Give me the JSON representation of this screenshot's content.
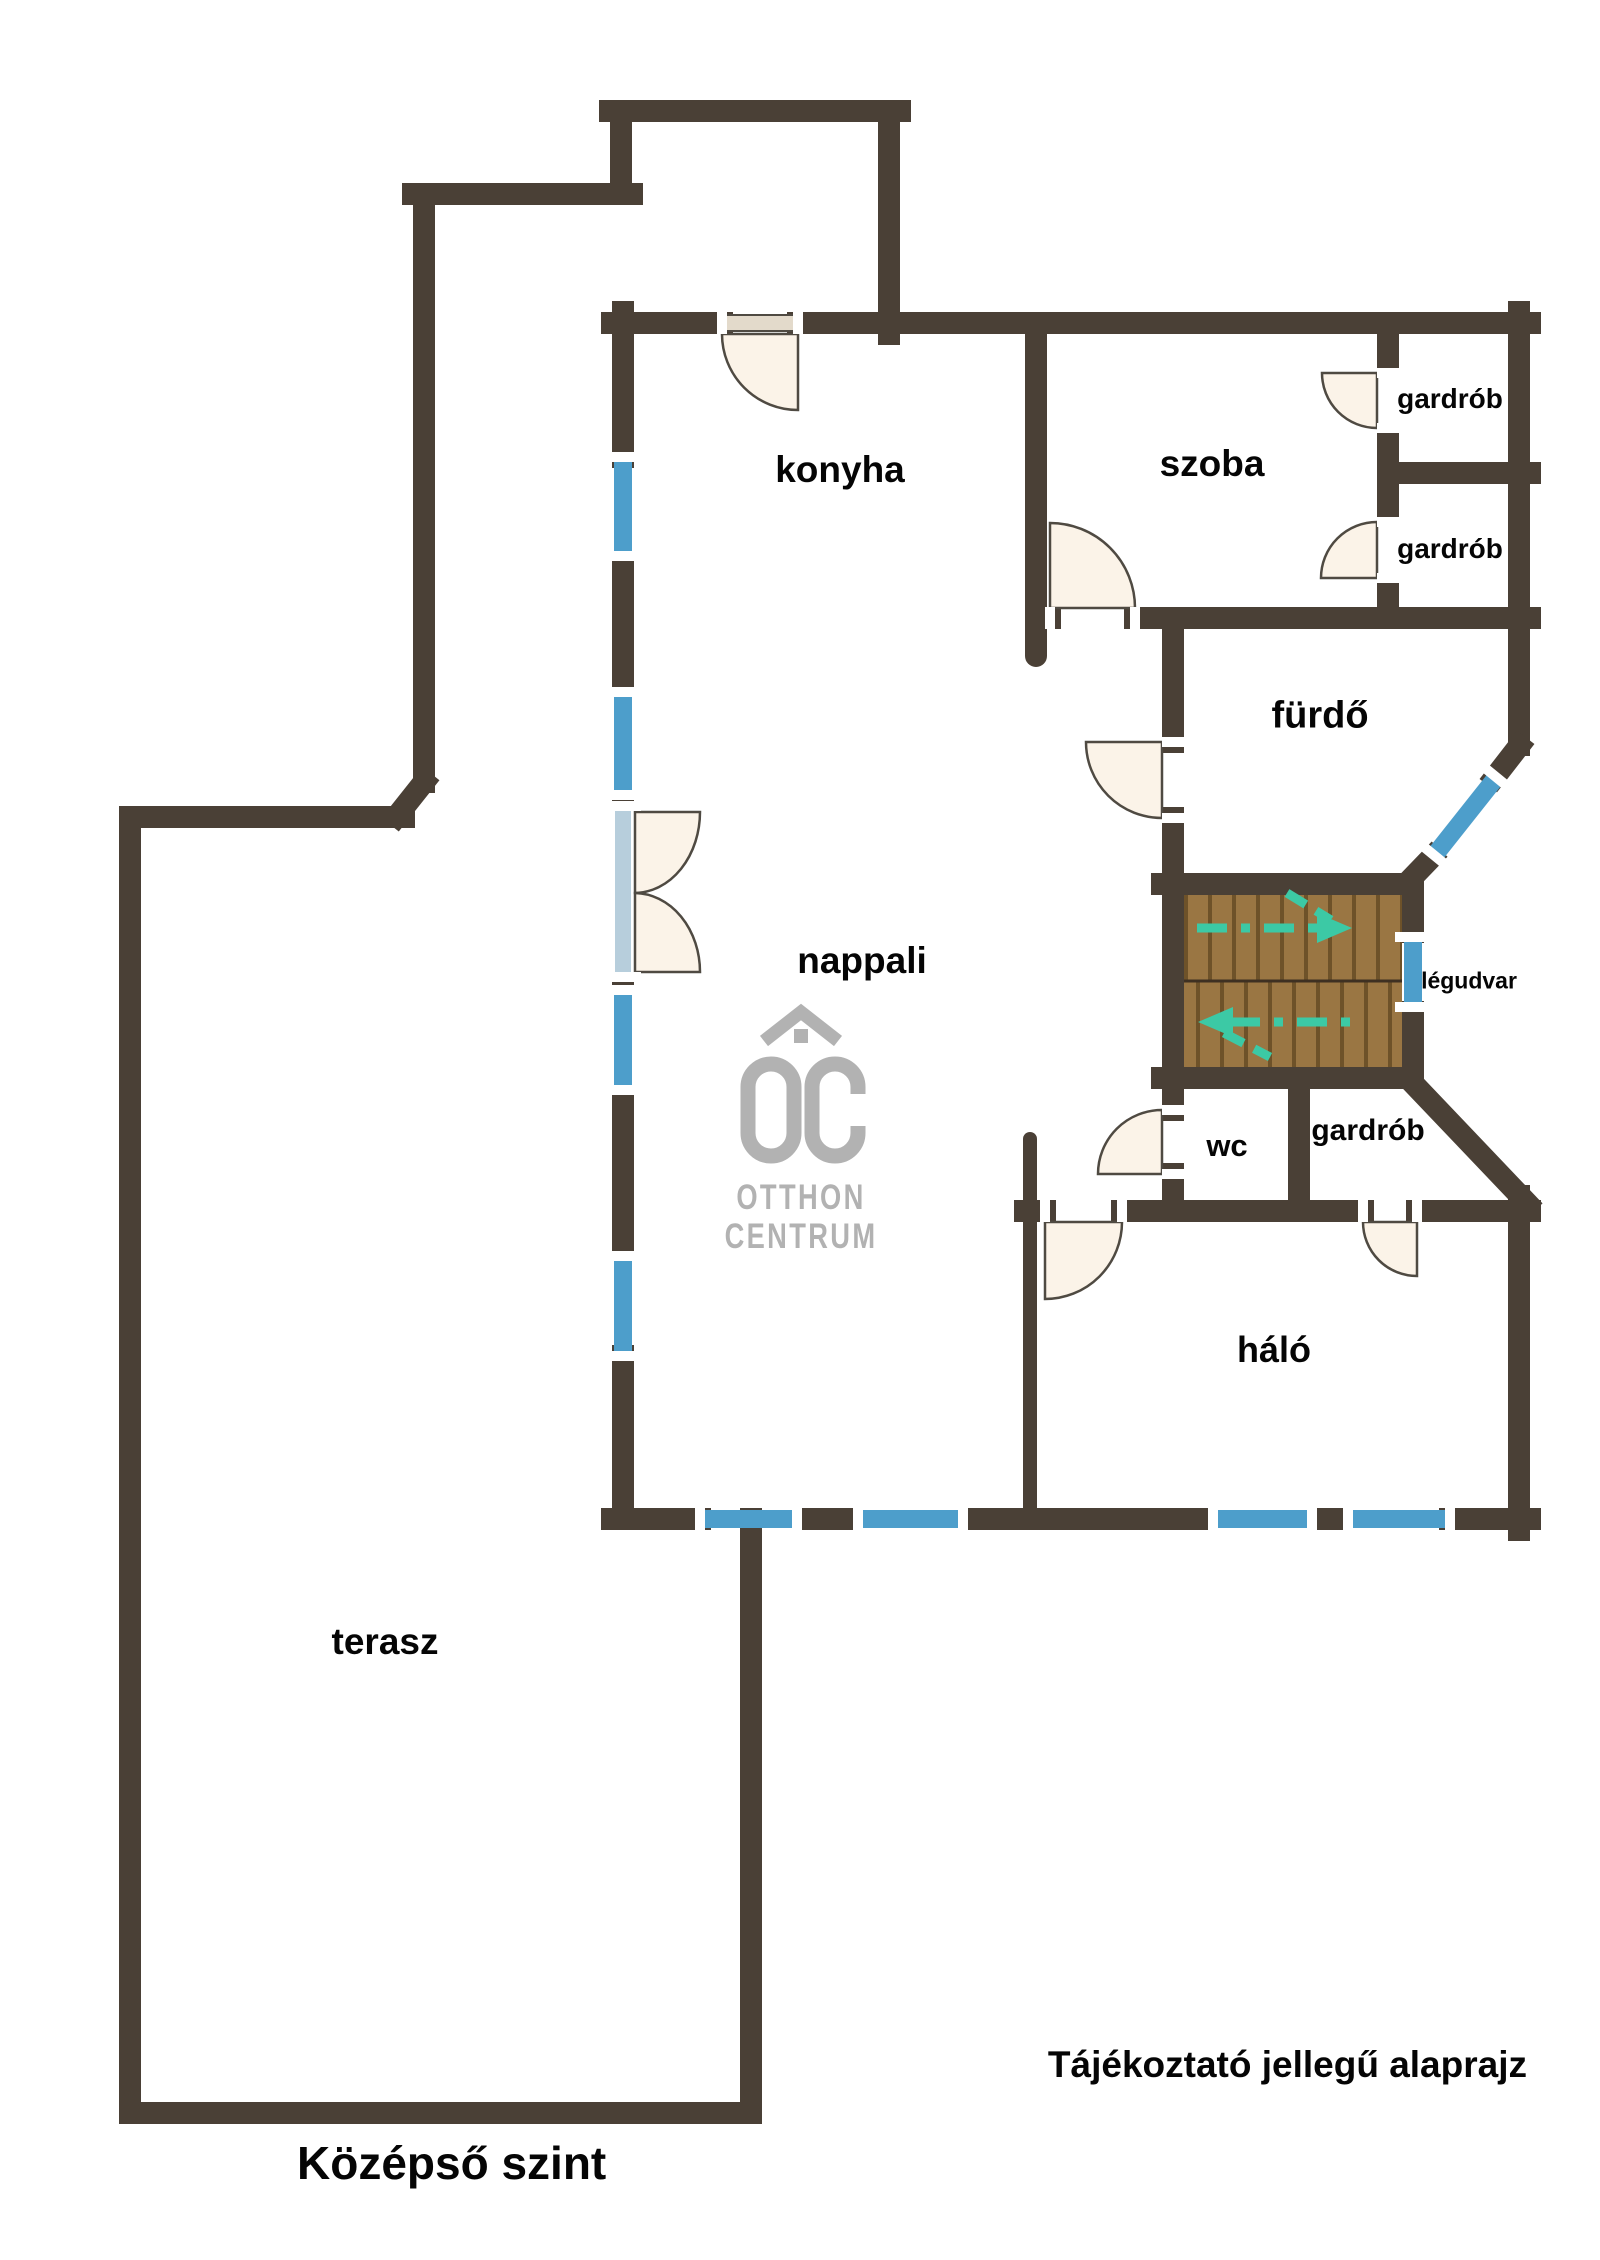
{
  "plan": {
    "level_title": "Középső szint",
    "disclaimer": "Tájékoztató jellegű alaprajz",
    "rooms": [
      {
        "label": "konyha"
      },
      {
        "label": "szoba"
      },
      {
        "label": "gardrób"
      },
      {
        "label": "gardrób"
      },
      {
        "label": "fürdő"
      },
      {
        "label": "nappali"
      },
      {
        "label": "légudvar"
      },
      {
        "label": "wc"
      },
      {
        "label": "gardrób"
      },
      {
        "label": "háló"
      },
      {
        "label": "terasz"
      }
    ]
  },
  "logo": {
    "monogram": "OC",
    "line1": "OTTHON",
    "line2": "CENTRUM"
  },
  "colors": {
    "wall": "#4A4036",
    "window": "#4D9ECB",
    "glazing": "#B7CEDC",
    "door": "#FBF3E8",
    "doortan": "#E3DACB",
    "doorline": "#4F4A42",
    "wood1": "#9A7643",
    "woodline": "#6E5229",
    "stairdiv": "#3E3022",
    "teal": "#3CC9A5",
    "logogray": "#B2B2B2"
  }
}
